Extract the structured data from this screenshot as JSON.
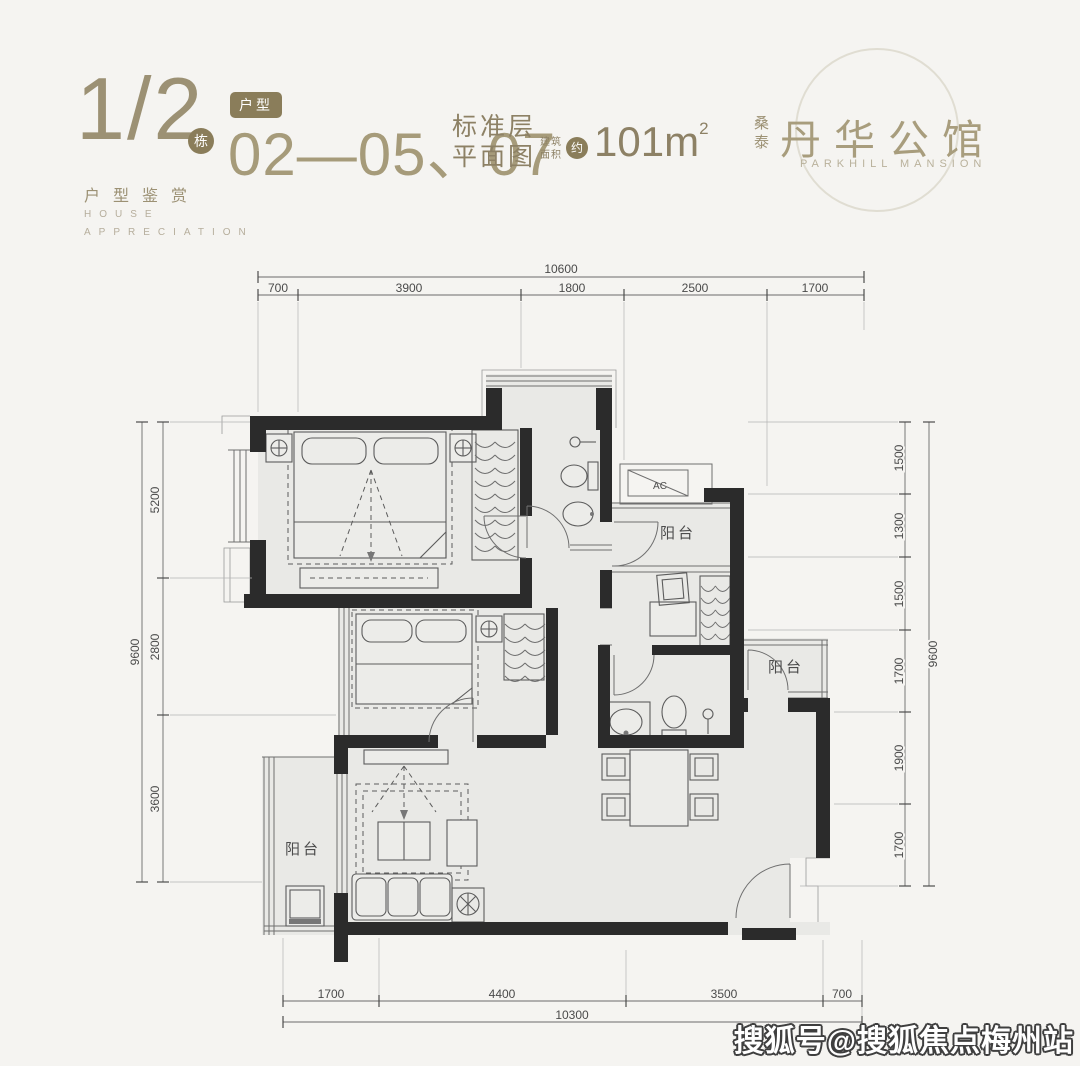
{
  "header": {
    "block": "1/2",
    "block_suffix": "栋",
    "unit_badge": "户型",
    "unit_numbers": "02—05、07",
    "plan_type_line1": "标准层",
    "plan_type_line2": "平面图",
    "area_label_line1": "建筑",
    "area_label_line2": "面积",
    "area_approx": "约",
    "area_value": "101m",
    "area_unit_sup": "2",
    "series_cn": "户型鉴赏",
    "series_en_line1": "HOUSE",
    "series_en_line2": "APPRECIATION"
  },
  "brand": {
    "prefix": "桑泰",
    "name": "丹华公馆",
    "name_en": "PARKHILL MANSION"
  },
  "plan": {
    "labels": {
      "balcony": "阳台",
      "ac": "AC"
    },
    "dims": {
      "top_total": "10600",
      "top": [
        "700",
        "3900",
        "1800",
        "2500",
        "1700"
      ],
      "bottom_total": "10300",
      "bottom": [
        "1700",
        "4400",
        "3500",
        "700"
      ],
      "left_total": "9600",
      "left": [
        "5200",
        "2800",
        "3600"
      ],
      "right_total": "9600",
      "right": [
        "1500",
        "1300",
        "1500",
        "1700",
        "1900",
        "1700"
      ]
    }
  },
  "watermark": "搜狐号@搜狐焦点梅州站",
  "colors": {
    "accent": "#9c9174",
    "badge": "#8a7d5a",
    "wall": "#2b2b2b",
    "room": "#e9e9e6"
  }
}
